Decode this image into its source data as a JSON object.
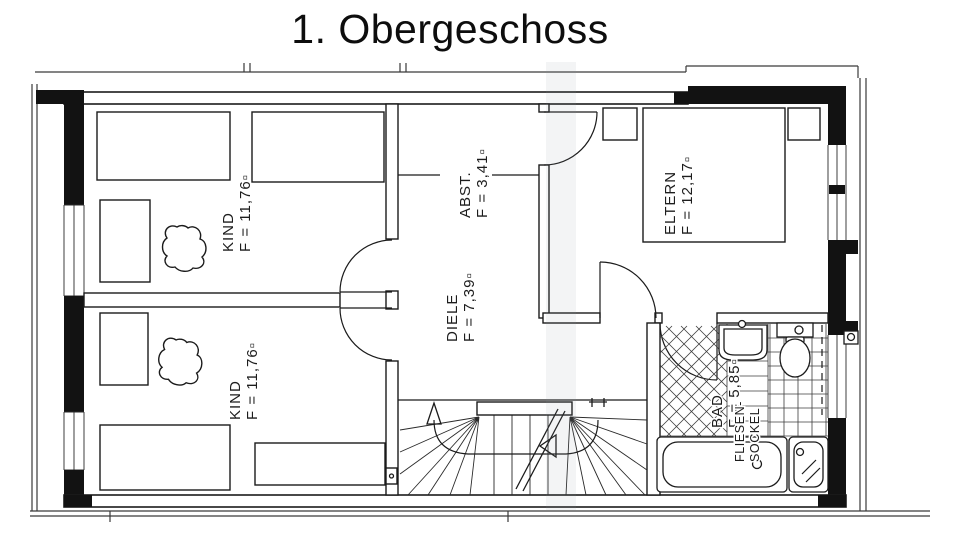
{
  "title": "1. Obergeschoss",
  "rooms": [
    {
      "id": "kind-upper",
      "name": "KIND",
      "area": "F = 11,76▫"
    },
    {
      "id": "kind-lower",
      "name": "KIND",
      "area": "F = 11,76▫"
    },
    {
      "id": "abstellraum",
      "name": "ABST.",
      "area": "F = 3,41▫"
    },
    {
      "id": "eltern",
      "name": "ELTERN",
      "area": "F = 12,17▫"
    },
    {
      "id": "diele",
      "name": "DIELE",
      "area": "F = 7,39▫"
    },
    {
      "id": "bad",
      "name": "BAD",
      "area": "F = 5,85▫"
    }
  ],
  "annotations": {
    "tile_skirting_line1": "FLIESEN-",
    "tile_skirting_line2": "SOCKEL"
  }
}
